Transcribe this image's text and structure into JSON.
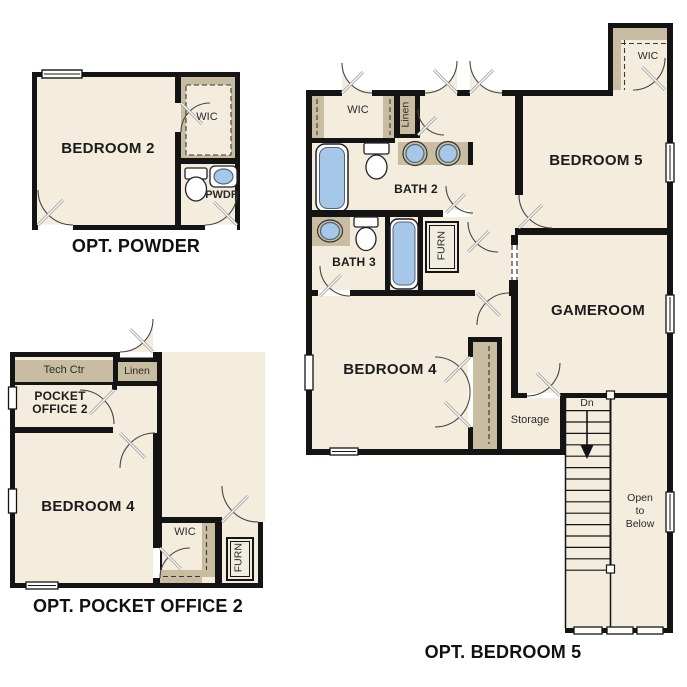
{
  "colors": {
    "wall": "#141414",
    "room_fill": "#f4edde",
    "accent_tan": "#c9bda1",
    "fixture_blue": "#a7c7e8",
    "background": "#ffffff"
  },
  "plans": {
    "powder": {
      "caption": "OPT. POWDER",
      "labels": {
        "bedroom2": "BEDROOM 2",
        "wic": "WIC",
        "pwdr": "PWDR"
      }
    },
    "pocket_office": {
      "caption": "OPT. POCKET OFFICE 2",
      "labels": {
        "tech_ctr": "Tech Ctr",
        "linen": "Linen",
        "pocket_office_line1": "POCKET",
        "pocket_office_line2": "OFFICE 2",
        "bedroom4": "BEDROOM 4",
        "wic": "WIC",
        "furn": "FURN"
      }
    },
    "bedroom5": {
      "caption": "OPT. BEDROOM 5",
      "labels": {
        "wic_hall": "WIC",
        "linen": "Linen",
        "bath2": "BATH 2",
        "bedroom5": "BEDROOM 5",
        "wic_bedroom5": "WIC",
        "bath3": "BATH 3",
        "furn": "FURN",
        "gameroom": "GAMEROOM",
        "bedroom4": "BEDROOM 4",
        "storage": "Storage",
        "stairs_dn": "Dn",
        "open_to_below_line1": "Open",
        "open_to_below_line2": "to",
        "open_to_below_line3": "Below"
      }
    }
  }
}
